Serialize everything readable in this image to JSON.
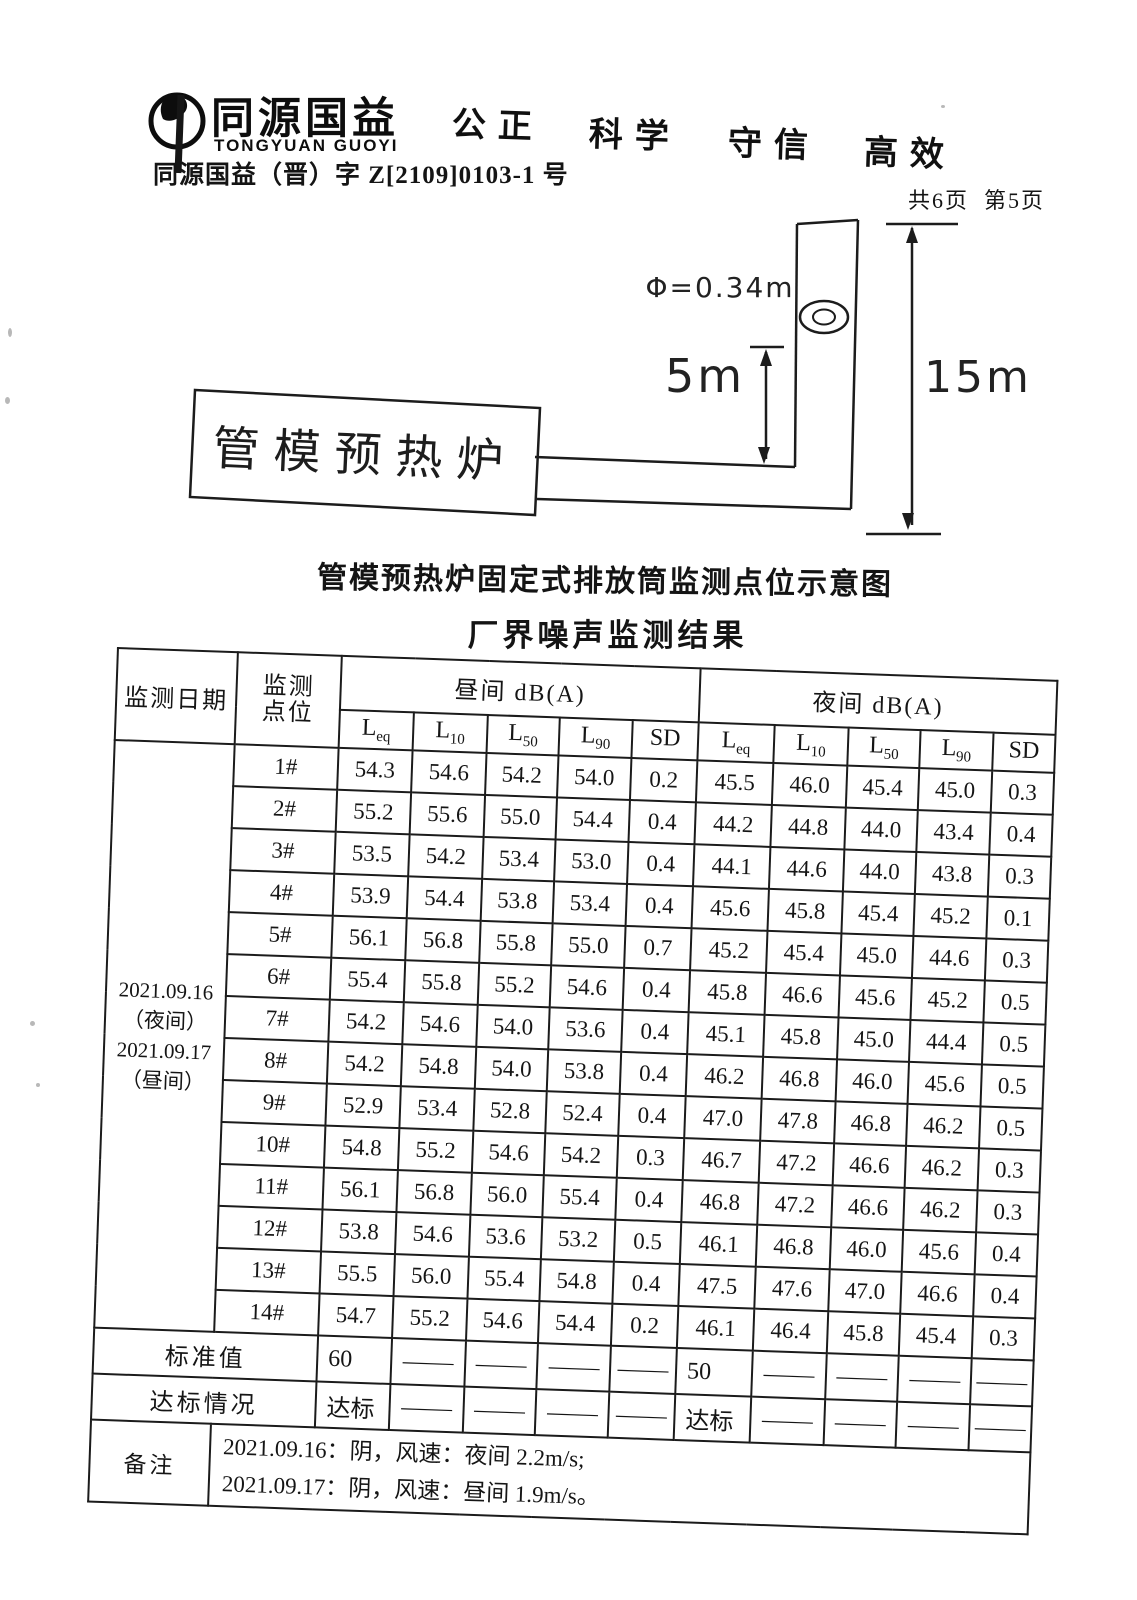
{
  "header": {
    "brand_cn": "同源国益",
    "brand_en": "TONGYUAN GUOYI",
    "slogans": [
      "公正",
      "科学",
      "守信",
      "高效"
    ],
    "doc_number": "同源国益（晋）字 Z[2109]0103-1 号",
    "page_info": "共6页  第5页"
  },
  "diagram": {
    "furnace_label": "管模预热炉",
    "diameter_label": "Φ=0.34m",
    "port_height_label": "5m",
    "stack_height_label": "15m",
    "caption": "管模预热炉固定式排放筒监测点位示意图"
  },
  "table": {
    "title": "厂界噪声监测结果",
    "header": {
      "date": "监测日期",
      "point_line1": "监测",
      "point_line2": "点位",
      "day_group": "昼间 dB(A)",
      "night_group": "夜间 dB(A)",
      "metrics": [
        {
          "main": "L",
          "sub": "eq"
        },
        {
          "main": "L",
          "sub": "10"
        },
        {
          "main": "L",
          "sub": "50"
        },
        {
          "main": "L",
          "sub": "90"
        },
        {
          "main": "SD",
          "sub": ""
        }
      ]
    },
    "date_lines": [
      "2021.09.16",
      "（夜间）",
      "2021.09.17",
      "（昼间）"
    ],
    "rows": [
      {
        "point": "1#",
        "day": [
          "54.3",
          "54.6",
          "54.2",
          "54.0",
          "0.2"
        ],
        "night": [
          "45.5",
          "46.0",
          "45.4",
          "45.0",
          "0.3"
        ]
      },
      {
        "point": "2#",
        "day": [
          "55.2",
          "55.6",
          "55.0",
          "54.4",
          "0.4"
        ],
        "night": [
          "44.2",
          "44.8",
          "44.0",
          "43.4",
          "0.4"
        ]
      },
      {
        "point": "3#",
        "day": [
          "53.5",
          "54.2",
          "53.4",
          "53.0",
          "0.4"
        ],
        "night": [
          "44.1",
          "44.6",
          "44.0",
          "43.8",
          "0.3"
        ]
      },
      {
        "point": "4#",
        "day": [
          "53.9",
          "54.4",
          "53.8",
          "53.4",
          "0.4"
        ],
        "night": [
          "45.6",
          "45.8",
          "45.4",
          "45.2",
          "0.1"
        ]
      },
      {
        "point": "5#",
        "day": [
          "56.1",
          "56.8",
          "55.8",
          "55.0",
          "0.7"
        ],
        "night": [
          "45.2",
          "45.4",
          "45.0",
          "44.6",
          "0.3"
        ]
      },
      {
        "point": "6#",
        "day": [
          "55.4",
          "55.8",
          "55.2",
          "54.6",
          "0.4"
        ],
        "night": [
          "45.8",
          "46.6",
          "45.6",
          "45.2",
          "0.5"
        ]
      },
      {
        "point": "7#",
        "day": [
          "54.2",
          "54.6",
          "54.0",
          "53.6",
          "0.4"
        ],
        "night": [
          "45.1",
          "45.8",
          "45.0",
          "44.4",
          "0.5"
        ]
      },
      {
        "point": "8#",
        "day": [
          "54.2",
          "54.8",
          "54.0",
          "53.8",
          "0.4"
        ],
        "night": [
          "46.2",
          "46.8",
          "46.0",
          "45.6",
          "0.5"
        ]
      },
      {
        "point": "9#",
        "day": [
          "52.9",
          "53.4",
          "52.8",
          "52.4",
          "0.4"
        ],
        "night": [
          "47.0",
          "47.8",
          "46.8",
          "46.2",
          "0.5"
        ]
      },
      {
        "point": "10#",
        "day": [
          "54.8",
          "55.2",
          "54.6",
          "54.2",
          "0.3"
        ],
        "night": [
          "46.7",
          "47.2",
          "46.6",
          "46.2",
          "0.3"
        ]
      },
      {
        "point": "11#",
        "day": [
          "56.1",
          "56.8",
          "56.0",
          "55.4",
          "0.4"
        ],
        "night": [
          "46.8",
          "47.2",
          "46.6",
          "46.2",
          "0.3"
        ]
      },
      {
        "point": "12#",
        "day": [
          "53.8",
          "54.6",
          "53.6",
          "53.2",
          "0.5"
        ],
        "night": [
          "46.1",
          "46.8",
          "46.0",
          "45.6",
          "0.4"
        ]
      },
      {
        "point": "13#",
        "day": [
          "55.5",
          "56.0",
          "55.4",
          "54.8",
          "0.4"
        ],
        "night": [
          "47.5",
          "47.6",
          "47.0",
          "46.6",
          "0.4"
        ]
      },
      {
        "point": "14#",
        "day": [
          "54.7",
          "55.2",
          "54.6",
          "54.4",
          "0.2"
        ],
        "night": [
          "46.1",
          "46.4",
          "45.8",
          "45.4",
          "0.3"
        ]
      }
    ],
    "standard_row": {
      "label": "标准值",
      "day": [
        "60",
        "—",
        "—",
        "—",
        "—"
      ],
      "night": [
        "50",
        "—",
        "—",
        "—",
        "—"
      ]
    },
    "compliance_row": {
      "label": "达标情况",
      "day": [
        "达标",
        "—",
        "—",
        "—",
        "—"
      ],
      "night": [
        "达标",
        "—",
        "—",
        "—",
        "—"
      ]
    },
    "remark_row": {
      "label": "备注",
      "lines": [
        "2021.09.16：阴，风速：夜间 2.2m/s;",
        "2021.09.17：阴，风速：昼间 1.9m/s。"
      ]
    }
  }
}
